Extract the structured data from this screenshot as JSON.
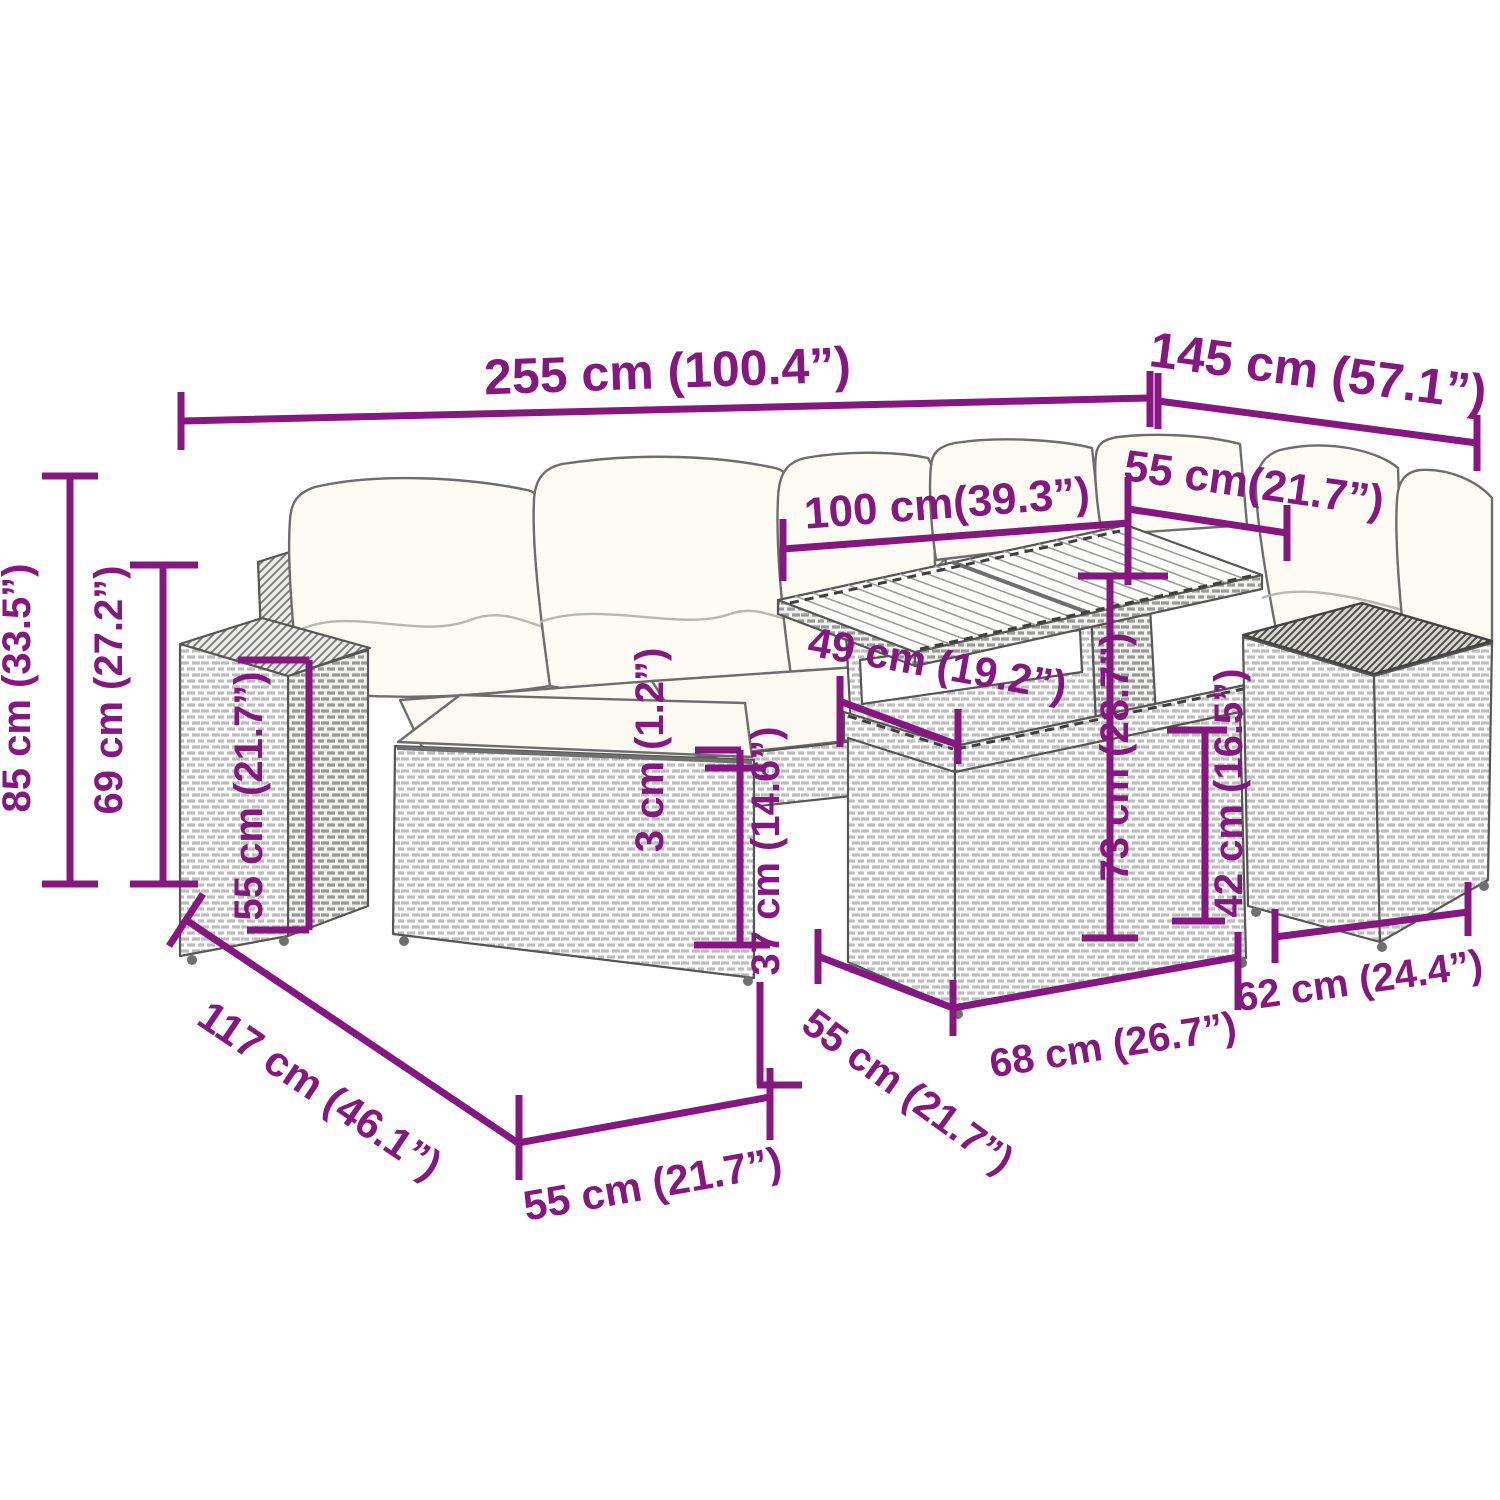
{
  "diagram": {
    "subject": "7-piece-rattan-garden-lounge-set-with-table-and-cushions",
    "view": "isometric-line-art-with-dimension-callouts"
  },
  "colors": {
    "dimension_line": "#871780",
    "line_art": "#565656",
    "cushion_fill": "#fcfbf4",
    "background": "#ffffff"
  },
  "dims": {
    "total_width": "255 cm (100.4”)",
    "depth_right": "145 cm (57.1”)",
    "table_width": "100 cm(39.3”)",
    "table_depth": "55 cm(21.7”)",
    "shelf_width": "49 cm (19.2”)",
    "total_height": "85 cm (33.5”)",
    "backrest_height": "69 cm (27.2”)",
    "armrest_height": "55 cm (21.7”)",
    "cushion_thickness": "3 cm (1.2”)",
    "seat_height": "37 cm (14.6”)",
    "table_height": "73 cm (28.7”)",
    "side_table_height": "42 cm (16.5”)",
    "sofa_depth": "117 cm (46.1”)",
    "seat_width": "55 cm (21.7”)",
    "module_depth": "55 cm (21.7”)",
    "module_width": "68 cm (26.7”)",
    "side_table_width": "62 cm (24.4”)"
  }
}
